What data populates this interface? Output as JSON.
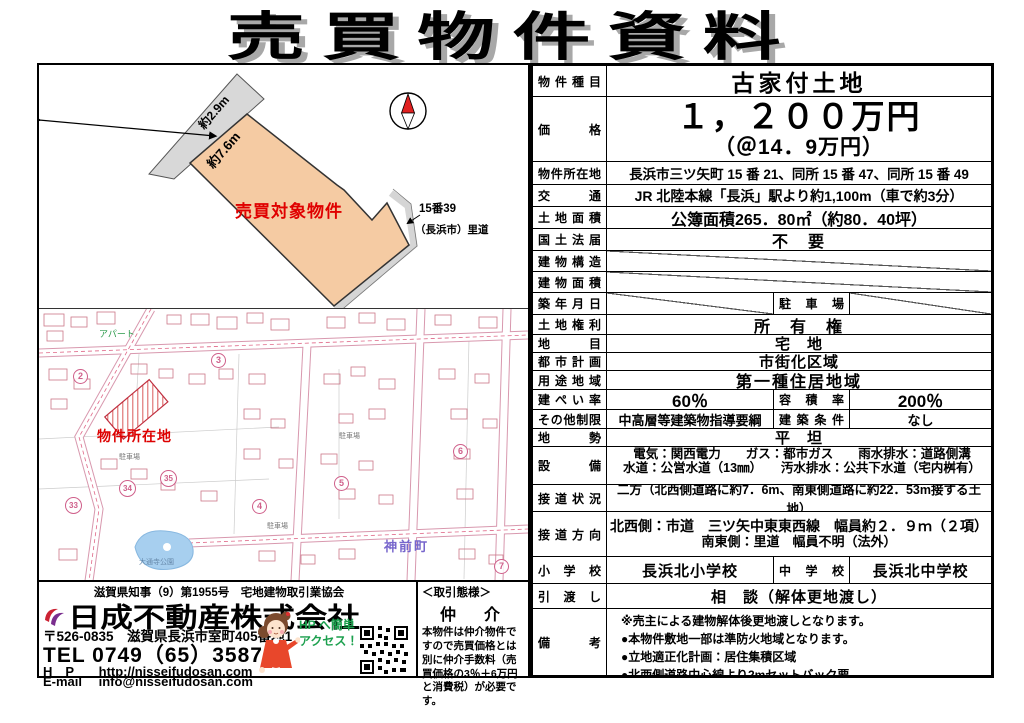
{
  "page_title": "売買物件資料",
  "table": {
    "rows": {
      "type": {
        "label": "物件種目",
        "value": "古家付土地"
      },
      "price": {
        "label": "価格",
        "value": "１，２００万円",
        "unit_price": "（＠14．9万円）"
      },
      "location": {
        "label": "物件所在地",
        "value": "長浜市三ツ矢町 15 番 21、同所 15 番 47、同所 15 番 49"
      },
      "access": {
        "label": "交通",
        "value": "JR 北陸本線「長浜」駅より約1,100m（車で約3分）"
      },
      "land_area": {
        "label": "土地面積",
        "value": "公簿面積265．80㎡（約80．40坪）"
      },
      "land_act": {
        "label": "国土法届",
        "value": "不　要"
      },
      "building_structure": {
        "label": "建物構造"
      },
      "building_area": {
        "label": "建物面積"
      },
      "built_date": {
        "label": "築年月日",
        "mid_label": "駐車場"
      },
      "land_rights": {
        "label": "土地権利",
        "value": "所　有　権"
      },
      "land_category": {
        "label": "地目",
        "value": "宅　地"
      },
      "city_planning": {
        "label": "都市計画",
        "value": "市街化区域"
      },
      "use_district": {
        "label": "用途地域",
        "value": "第一種住居地域"
      },
      "coverage_ratio": {
        "label": "建ぺい率",
        "value": "60％",
        "mid_label": "容積率",
        "value2": "200％"
      },
      "other_restrictions": {
        "label": "その他制限",
        "value": "中高層等建築物指導要綱",
        "mid_label": "建築条件",
        "value2": "なし"
      },
      "terrain": {
        "label": "地勢",
        "value": "平　坦"
      },
      "utilities": {
        "label": "設備",
        "line1": "電気：関西電力　　ガス：都市ガス　　雨水排水：道路側溝",
        "line2": "水道：公営水道（13㎜）　　汚水排水：公共下水道（宅内桝有）"
      },
      "road_frontage": {
        "label": "接道状況",
        "value": "二方（北西側道路に約7．6m、南東側道路に約22．53m接する土地）"
      },
      "road_direction": {
        "label": "接道方向",
        "line1": "北西側：市道　三ツ矢中東東西線　幅員約２．９ｍ（２項）",
        "line2": "南東側：里道　幅員不明（法外）"
      },
      "schools": {
        "label": "小学校",
        "value": "長浜北小学校",
        "mid_label": "中学校",
        "value2": "長浜北中学校"
      },
      "handover": {
        "label": "引渡し",
        "value": "相　談（解体更地渡し）"
      },
      "remarks": {
        "label": "備考",
        "line1": "※売主による建物解体後更地渡しとなります。",
        "line2": "●本物件敷地一部は準防火地域となります。",
        "line3": "●立地適正化計画：居住集積区域",
        "line4": "●北西側道路中心線より2mセットバック要。"
      }
    }
  },
  "plot_diagram": {
    "road_width_label": "約2.9m",
    "frontage_label": "約7.6m",
    "parcel_label": "売買対象物件",
    "ridou_number": "15番39",
    "ridou_owner": "（長浜市）里道"
  },
  "map": {
    "property_marker_label": "物件所在地",
    "town_name": "神前町",
    "apartment_label": "アパート",
    "park_label": "大通寺公園",
    "parking_label": "駐車場",
    "badges": {
      "b2": "2",
      "b3": "3",
      "b4": "4",
      "b5": "5",
      "b6": "6",
      "b7": "7",
      "b33": "33",
      "b34": "34",
      "b35": "35"
    }
  },
  "agency": {
    "license_line": "滋賀県知事（9）第1955号　宅地建物取引業協会",
    "company_name": "日成不動産株式会社",
    "address": "〒526-0835　滋賀県長浜市室町405番地1",
    "tel_label": "TEL",
    "tel": "0749（65）3587",
    "hp_label": "H　P",
    "hp": "http://nisseifudosan.com",
    "email_label": "E-mail",
    "email": "info@nisseifudosan.com",
    "hp_access_line1": "HP へ簡単",
    "hp_access_line2": "アクセス！"
  },
  "brokerage": {
    "header": "＜取引態様＞",
    "type": "仲　介",
    "note": "本物件は仲介物件ですので売買価格とは別に仲介手数料（売買価格の3％＋6万円と消費税）が必要です。"
  },
  "colors": {
    "parcel_fill": "#f5cba3",
    "road_gray": "#d8d8d8",
    "accent_red": "#dd0000",
    "map_pink": "#d898ae",
    "green": "#1ca04e",
    "pond_blue": "#a7cfef",
    "town_violet": "#7766cc"
  }
}
